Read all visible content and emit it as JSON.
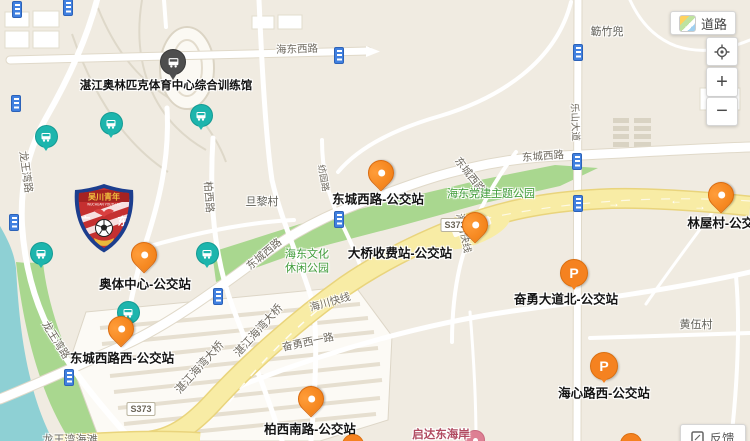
{
  "map": {
    "p_glyph": "P",
    "venue": {
      "name": "湛江奥林匹克体育中心综合训练馆",
      "marker": {
        "x": 172,
        "y": 62
      },
      "label": {
        "x": 166,
        "y": 85
      }
    },
    "bus_stops": [
      {
        "name": "东城西路-公交站",
        "pin": {
          "x": 380,
          "y": 174
        },
        "label": {
          "x": 378,
          "y": 198
        }
      },
      {
        "name": "大桥收费站-公交站",
        "pin": {
          "x": 474,
          "y": 226
        },
        "label": {
          "x": 400,
          "y": 252
        }
      },
      {
        "name": "奥体中心-公交站",
        "pin": {
          "x": 143,
          "y": 256
        },
        "label": {
          "x": 145,
          "y": 283
        }
      },
      {
        "name": "东城西路西-公交站",
        "pin": {
          "x": 120,
          "y": 330
        },
        "label": {
          "x": 122,
          "y": 357
        }
      },
      {
        "name": "柏西南路-公交站",
        "pin": {
          "x": 310,
          "y": 400
        },
        "label": {
          "x": 310,
          "y": 428
        }
      },
      {
        "name": "林屋村-公交站",
        "pin": {
          "x": 720,
          "y": 196
        },
        "label": {
          "x": 727,
          "y": 222
        }
      }
    ],
    "p_stops": [
      {
        "name": "奋勇大道北-公交站",
        "pin": {
          "x": 573,
          "y": 272
        },
        "label": {
          "x": 566,
          "y": 298
        }
      },
      {
        "name": "海心路西-公交站",
        "pin": {
          "x": 603,
          "y": 365
        },
        "label": {
          "x": 604,
          "y": 392
        }
      }
    ],
    "teal_markers": [
      {
        "x": 45,
        "y": 136
      },
      {
        "x": 110,
        "y": 123
      },
      {
        "x": 200,
        "y": 115
      },
      {
        "x": 40,
        "y": 253
      },
      {
        "x": 206,
        "y": 253
      },
      {
        "x": 127,
        "y": 312
      }
    ],
    "traffic_icons": [
      {
        "x": 16,
        "y": 8
      },
      {
        "x": 67,
        "y": 6
      },
      {
        "x": 15,
        "y": 102
      },
      {
        "x": 13,
        "y": 221
      },
      {
        "x": 338,
        "y": 54
      },
      {
        "x": 577,
        "y": 51
      },
      {
        "x": 576,
        "y": 160
      },
      {
        "x": 577,
        "y": 202
      },
      {
        "x": 338,
        "y": 218
      },
      {
        "x": 217,
        "y": 295
      },
      {
        "x": 68,
        "y": 376
      }
    ],
    "clipped_markers": [
      {
        "x": 352,
        "y": 444
      },
      {
        "x": 630,
        "y": 443
      }
    ],
    "resort": {
      "name": "启达东海岸",
      "label": {
        "x": 441,
        "y": 434
      },
      "marker": {
        "x": 474,
        "y": 439
      }
    },
    "beach": {
      "name": "龙王湾海滩",
      "x": 70,
      "y": 439
    },
    "place_labels": [
      {
        "t": "簕竹兜",
        "x": 607,
        "y": 31
      },
      {
        "t": "旦黎村",
        "x": 262,
        "y": 201
      },
      {
        "t": "黄伍村",
        "x": 696,
        "y": 324
      }
    ],
    "park_labels": [
      {
        "t": "海东党建主题公园",
        "x": 491,
        "y": 195
      },
      {
        "t": "海东文化\n休闲公园",
        "x": 307,
        "y": 262
      }
    ],
    "road_labels": [
      {
        "t": "海东西路",
        "x": 297,
        "y": 49,
        "r": -2
      },
      {
        "t": "东城西路",
        "x": 543,
        "y": 156,
        "r": -4
      },
      {
        "t": "东城西路",
        "x": 470,
        "y": 175,
        "r": 52
      },
      {
        "t": "东城西路",
        "x": 264,
        "y": 254,
        "r": -40
      },
      {
        "t": "龙王湾路",
        "x": 26,
        "y": 172,
        "r": 82
      },
      {
        "t": "龙王湾路",
        "x": 56,
        "y": 340,
        "r": 58
      },
      {
        "t": "柏西路",
        "x": 209,
        "y": 197,
        "r": 86
      },
      {
        "t": "纺园路",
        "x": 324,
        "y": 178,
        "r": 80,
        "size": 9
      },
      {
        "t": "乐山大道",
        "x": 576,
        "y": 122,
        "r": 88,
        "size": 9.5
      },
      {
        "t": "海川快线",
        "x": 330,
        "y": 302,
        "r": -16
      },
      {
        "t": "海川快线",
        "x": 465,
        "y": 233,
        "r": 78,
        "size": 10
      },
      {
        "t": "湛江海湾大桥",
        "x": 199,
        "y": 367,
        "r": -48,
        "size": 11
      },
      {
        "t": "湛江海湾大桥",
        "x": 258,
        "y": 330,
        "r": -48,
        "size": 11
      },
      {
        "t": "奋勇西一路",
        "x": 308,
        "y": 342,
        "r": -12
      }
    ],
    "shields": [
      {
        "t": "S373",
        "x": 455,
        "y": 225
      },
      {
        "t": "S373",
        "x": 141,
        "y": 409
      }
    ],
    "arrows": [
      {
        "g": "→",
        "x": 614,
        "y": 203
      },
      {
        "g": "←",
        "x": 676,
        "y": 200
      },
      {
        "g": "→",
        "x": 700,
        "y": 206
      }
    ]
  },
  "badge": {
    "club_cn": "吴川青年",
    "club_en": "WUCHUAN YOUTH FC",
    "left_char": "广",
    "right_char": "东",
    "x": 72,
    "y": 183
  },
  "controls": {
    "map_type_label": "道路",
    "zoom_in": "+",
    "zoom_out": "−",
    "feedback_label": "反馈"
  },
  "colors": {
    "bus_marker_orange": "#f58220",
    "teal_marker": "#1db5ad",
    "park_green": "#a9d78f",
    "road_yellow": "#f8eca5",
    "water": "#8ed0d4",
    "park_text_green": "#3e9b38",
    "resort_pink": "#b04a60"
  }
}
